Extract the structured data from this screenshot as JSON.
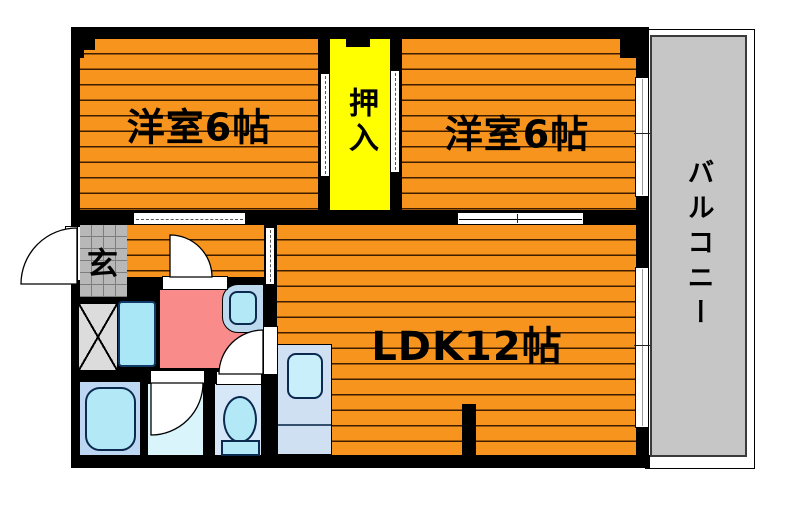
{
  "floorplan": {
    "rooms": {
      "bedroom1": {
        "label": "洋室6帖"
      },
      "bedroom2": {
        "label": "洋室6帖"
      },
      "ldk": {
        "label": "LDK12帖"
      },
      "closet": {
        "label": "押入"
      },
      "balcony": {
        "label": "バルコニー"
      },
      "entrance": {
        "label": "玄"
      }
    },
    "colors": {
      "flooring_orange": "#f7941e",
      "floor_line": "#3d1c00",
      "closet_yellow": "#ffff00",
      "balcony_gray": "#c6c6c6",
      "washroom_pink": "#f98b8b",
      "wall_black": "#000000",
      "entrance_tile_gray": "#b8b8b8",
      "bathroom_blue": "#bdd7f2",
      "tub_cyan": "#b3e9f7",
      "shower_pale_cyan": "#d9f4fb",
      "toilet_room_blue": "#d6e7f7",
      "kitchen_counter_blue": "#cfe0f3",
      "sink_cyan": "#c9effa",
      "laundry_pan_cyan": "#a9e6f6"
    }
  }
}
